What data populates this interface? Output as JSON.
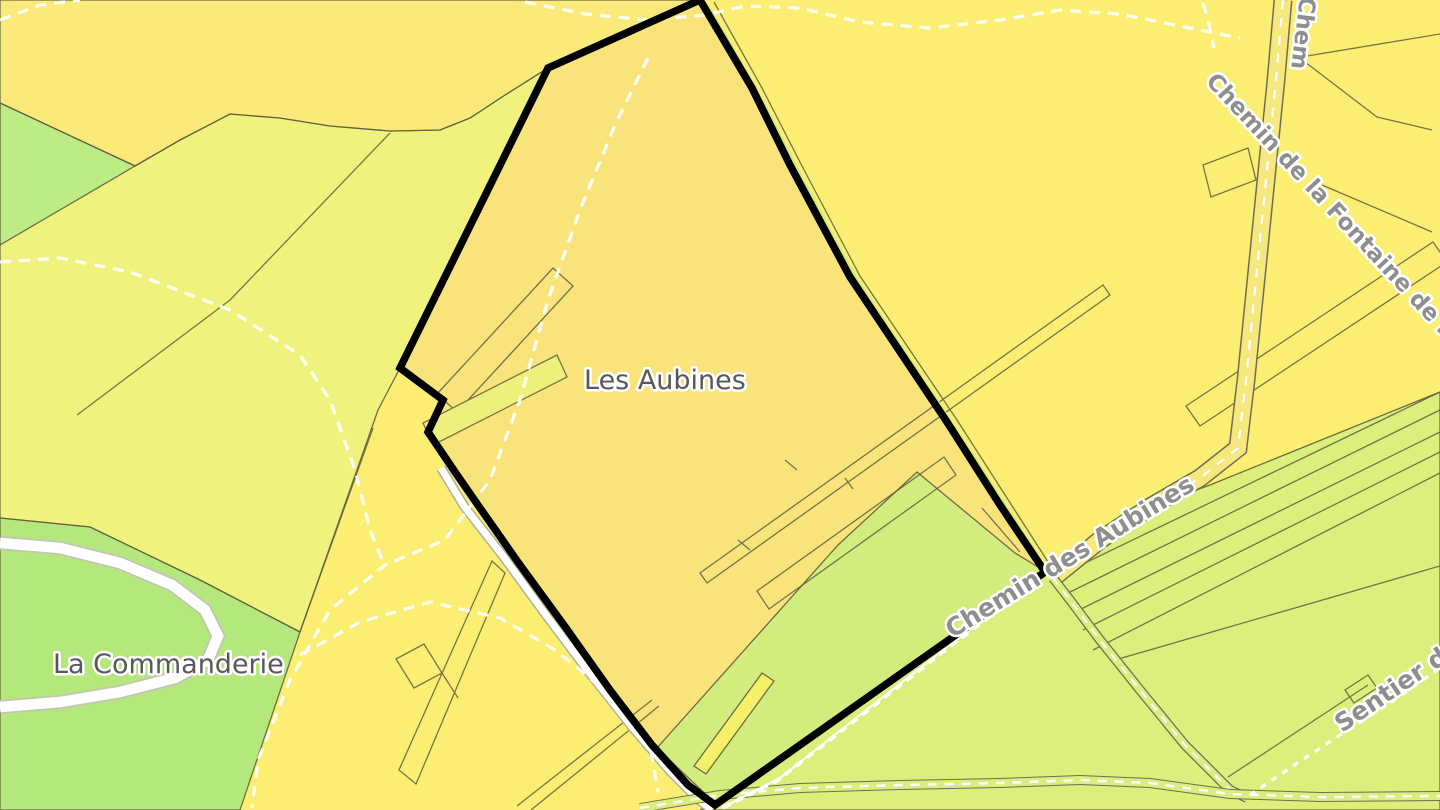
{
  "map": {
    "selected_parcel": {
      "name": "Les Aubines",
      "outline_color": "#000000",
      "fill_color": "#F9E47C"
    },
    "place_labels": [
      {
        "id": "les-aubines",
        "text": "Les Aubines"
      },
      {
        "id": "la-commanderie",
        "text": "La Commanderie"
      }
    ],
    "street_labels": [
      {
        "id": "chemin-des-aubines",
        "text": "Chemin des Aubines"
      },
      {
        "id": "chemin-de-la-fontaine",
        "text": "Chemin de la Fontaine de la Breu"
      },
      {
        "id": "chemin-top-edge",
        "text": "Chem"
      },
      {
        "id": "sentier-du",
        "text": "Sentier du"
      }
    ],
    "colors": {
      "parcel_yellow": "#FBEE72",
      "parcel_orange": "#FBE97B",
      "parcel_yellow_green": "#EEF480",
      "parcel_green": "#AEE87E",
      "parcel_green_wedge": "#B9EC85",
      "parcel_light_green": "#D9EE7E",
      "selected_interior_green": "#CEEF7E",
      "selected_fill": "#F9E47C",
      "boundary_black": "#000000",
      "road_white": "#FFFFFF",
      "road_yellow": "#F6E87E",
      "path_dash_white": "#FFFFFF",
      "label_place_gray": "#585858",
      "label_street_gray": "#8E8E8E"
    }
  }
}
